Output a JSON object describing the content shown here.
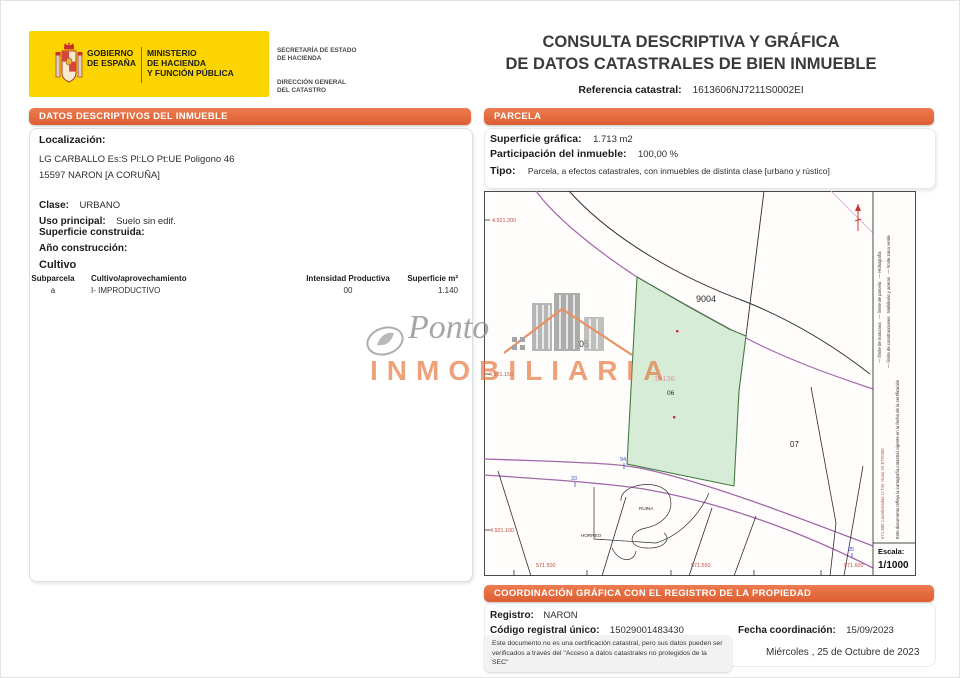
{
  "header": {
    "logo": {
      "gobierno": "GOBIERNO\nDE ESPAÑA",
      "ministerio": "MINISTERIO\nDE HACIENDA\nY FUNCIÓN PÚBLICA",
      "secretaria": "SECRETARÍA DE ESTADO\nDE HACIENDA",
      "direccion": "DIRECCIÓN GENERAL\nDEL CATASTRO"
    },
    "title_line1": "CONSULTA DESCRIPTIVA Y GRÁFICA",
    "title_line2": "DE DATOS CATASTRALES DE BIEN INMUEBLE",
    "ref_label": "Referencia catastral:",
    "ref_value": "1613606NJ7211S0002EI"
  },
  "inmueble": {
    "section_title": "DATOS DESCRIPTIVOS DEL INMUEBLE",
    "localizacion_label": "Localización:",
    "localizacion_line1": "LG CARBALLO  Es:S Pl:LO Pt:UE Poligono 46",
    "localizacion_line2": "15597 NARON [A CORUÑA]",
    "clase_label": "Clase:",
    "clase": "URBANO",
    "uso_label": "Uso principal:",
    "uso": "Suelo sin edif.",
    "superficie_label": "Superficie construida:",
    "ano_label": "Año construcción:",
    "cultivo": {
      "title": "Cultivo",
      "h_subparcela": "Subparcela",
      "h_cultivo": "Cultivo/aprovechamiento",
      "h_intensidad": "Intensidad Productiva",
      "h_superficie": "Superficie m²",
      "r_subparcela": "a",
      "r_cultivo": "I- IMPRODUCTIVO",
      "r_intensidad": "00",
      "r_superficie": "1.140"
    }
  },
  "parcela": {
    "section_title": "PARCELA",
    "superficie_label": "Superficie gráfica:",
    "superficie": "1.713 m2",
    "participacion_label": "Participación del inmueble:",
    "participacion": "100,00 %",
    "tipo_label": "Tipo:",
    "tipo": "Parcela, a efectos catastrales, con inmuebles de distinta clase [urbano y rústico]"
  },
  "map": {
    "coord_y1": "4.921.200",
    "coord_y2": "4.921.150",
    "coord_y3": "4.921.100",
    "coord_x1": "571.500",
    "coord_x2": "571.550",
    "coord_x3": "571.600",
    "label_9004": "9004",
    "label_05": "05",
    "label_16136": "16136",
    "label_06": "06",
    "label_07": "07",
    "road_n94": "94",
    "road_n33": "33",
    "road_n85": "85",
    "feature_ruina": "RUINA",
    "feature_horreo": "HORREO",
    "legend_line1": "— límite de manzana   — límite de parcela   — Hidrografía",
    "legend_line2": "— límite de construcciones   Mobiliario y aceras   — límite zona verde",
    "utm_note": "571.600 Coordenadas U.T.M. Huso 29 ETRS89",
    "margin_note": "Este documento refleja la cartografía catastral vigente en la fecha de la certificación",
    "escala_label": "Escala:",
    "escala_value": "1/1000"
  },
  "coordinacion": {
    "section_title": "COORDINACIÓN GRÁFICA CON EL REGISTRO DE LA PROPIEDAD",
    "registro_label": "Registro:",
    "registro": "NARON",
    "codigo_label": "Código registral único:",
    "codigo": "15029001483430",
    "fecha_label": "Fecha coordinación:",
    "fecha": "15/09/2023",
    "disclaimer": "Este documento no es una certificación catastral, pero sus datos pueden ser verificados a través del \"Acceso a datos catastrales no protegidos de la SEC\"",
    "fecha_documento": "Miércoles , 25 de Octubre de 2023"
  },
  "watermark": {
    "script": "Ponto",
    "caps": "INMOBILIARIA"
  },
  "colors": {
    "accent_orange": "#e0673c",
    "logo_yellow": "#fcd500",
    "parcel_green": "#d7ecd7",
    "road_purple": "#a168aa",
    "coord_red": "#c05045",
    "blue_number": "#3a56c4",
    "pink_label": "#e39aac"
  }
}
